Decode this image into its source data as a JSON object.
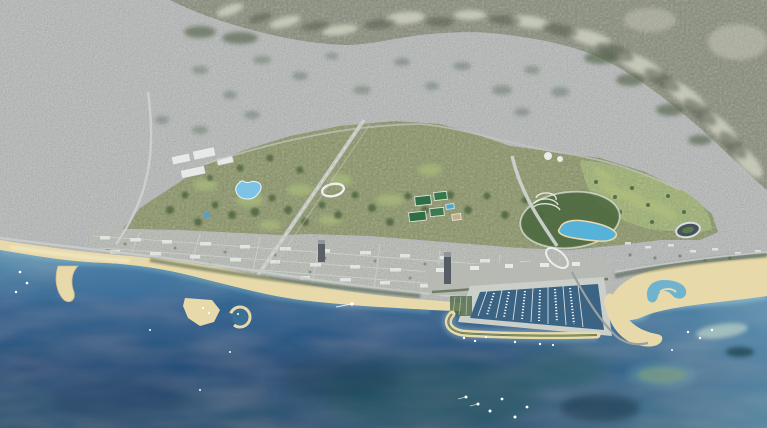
{
  "meta": {
    "width": 767,
    "height": 428,
    "description": "Oblique aerial rendering of a dense gray coastal city with mountain ridges along the top, a large landscaped waterfront park development with lakes, a golf course, sports fields and a circular lagoon park, rows of new development blocks, sandy beaches with a sand spit and a circular lagoon harbor, a large marina enclosed by a curved breakwater with a causeway, a hook-shaped sculpted beach, scattered small boats and deep blue sea with teal shoals in the foreground."
  },
  "scene": {
    "type": "aerial-render",
    "regions": [
      "city fabric",
      "mountain ridges",
      "foothill forest",
      "park development",
      "main lake",
      "ponds",
      "lagoon",
      "golf course",
      "stadium",
      "sports fields",
      "exhibition halls",
      "ring pavilion",
      "amphitheater terraces",
      "development blocks",
      "coastal esplanade",
      "high-rise tower",
      "beaches",
      "sand spit",
      "circular lagoon harbor",
      "marina basin",
      "boat piers",
      "breakwater",
      "causeway",
      "road interchange",
      "hook-shaped beach",
      "runway axis road",
      "coastal highway",
      "sea",
      "shoals",
      "boats"
    ]
  },
  "palette": {
    "city": "#b3b7b6",
    "blocks": "#b5b9b1",
    "mountain": "#868b78",
    "mountain_light": "#cdd0bf",
    "mountain_shadow": "#50564a",
    "forest": "#4f5f45",
    "park": "#87935f",
    "park_dark": "#485f3c",
    "park_light": "#a7b87c",
    "golf": "#9cb06c",
    "lake": "#7cc3e6",
    "lagoon": "#57b2da",
    "pond": "#5d9fc4",
    "sand": "#e8d9ab",
    "sand_shadow": "#cdb98c",
    "esplanade": "#b6bab2",
    "road": "#cbcfcd",
    "building": "#e7e9e7",
    "tower": "#596066",
    "marina_water": "#3b6384",
    "sea_shallow": "#5b95b4",
    "sea_mid": "#2e6492",
    "sea_deep": "#1f4e79",
    "sea_bottom": "#2a5473",
    "sea_teal": "#2b5d62",
    "sea_dark": "#16374f",
    "shoal": "#7d9b84",
    "boat": "#ffffff"
  }
}
